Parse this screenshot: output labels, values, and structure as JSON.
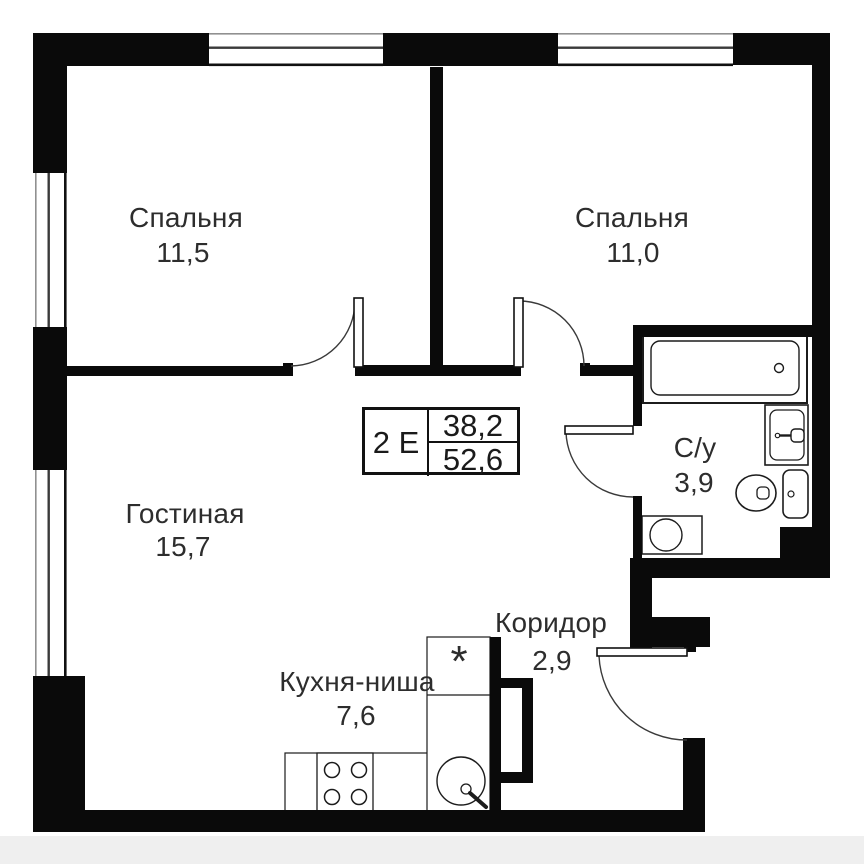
{
  "plan": {
    "apartment_type": "2 Е",
    "living_area": "38,2",
    "total_area": "52,6",
    "kitchen_marker": "*",
    "rooms": [
      {
        "name": "Спальня",
        "area": "11,5"
      },
      {
        "name": "Спальня",
        "area": "11,0"
      },
      {
        "name": "Гостиная",
        "area": "15,7"
      },
      {
        "name": "С/у",
        "area": "3,9"
      },
      {
        "name": "Коридор",
        "area": "2,9"
      },
      {
        "name": "Кухня-ниша",
        "area": "7,6"
      }
    ],
    "colors": {
      "wall": "#0a0a0a",
      "text": "#2d2d2d",
      "background": "#ffffff",
      "footer_strip": "#efefef"
    }
  }
}
